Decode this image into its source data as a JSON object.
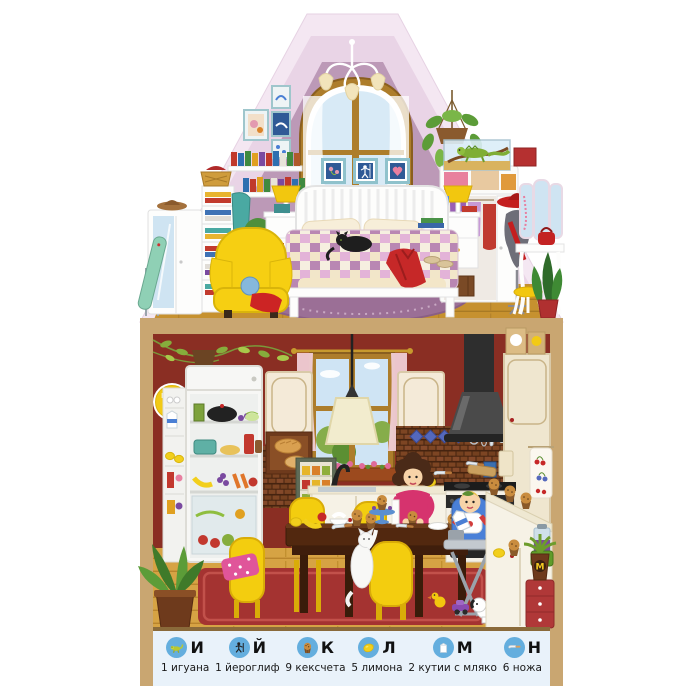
{
  "page": {
    "type": "seek-and-find picture page",
    "background": "#ffffff"
  },
  "legend": {
    "background": "#e9f2fa",
    "circle_color": "#64aede",
    "items": [
      {
        "letter": "И",
        "icon": "iguana-icon",
        "label": "1 игуана"
      },
      {
        "letter": "Й",
        "icon": "hieroglyph-icon",
        "label": "1 йероглиф"
      },
      {
        "letter": "К",
        "icon": "cupcake-icon",
        "label": "9 кексчета"
      },
      {
        "letter": "Л",
        "icon": "lemon-icon",
        "label": "5 лимона"
      },
      {
        "letter": "М",
        "icon": "milk-carton-icon",
        "label": "2 кутии с мляко"
      },
      {
        "letter": "Н",
        "icon": "knife-icon",
        "label": "6 ножа"
      }
    ]
  },
  "hidden_letters": {
    "on_clock": "К",
    "on_flower_pot": "М"
  },
  "colors": {
    "roof_outer": "#f4e7f2",
    "roof_inner": "#e9d4e6",
    "attic_wall": "#bc99b7",
    "attic_floor": "#c6912f",
    "frame_tan": "#c9a671",
    "kitchen_wall": "#8a2e23",
    "kitchen_floor": "#d6a344",
    "rug_red": "#a43331",
    "rug_attic": "#9b6f96",
    "accent_yellow": "#f3cd0f",
    "accent_red": "#c62828",
    "legend_blue": "#64aede"
  }
}
